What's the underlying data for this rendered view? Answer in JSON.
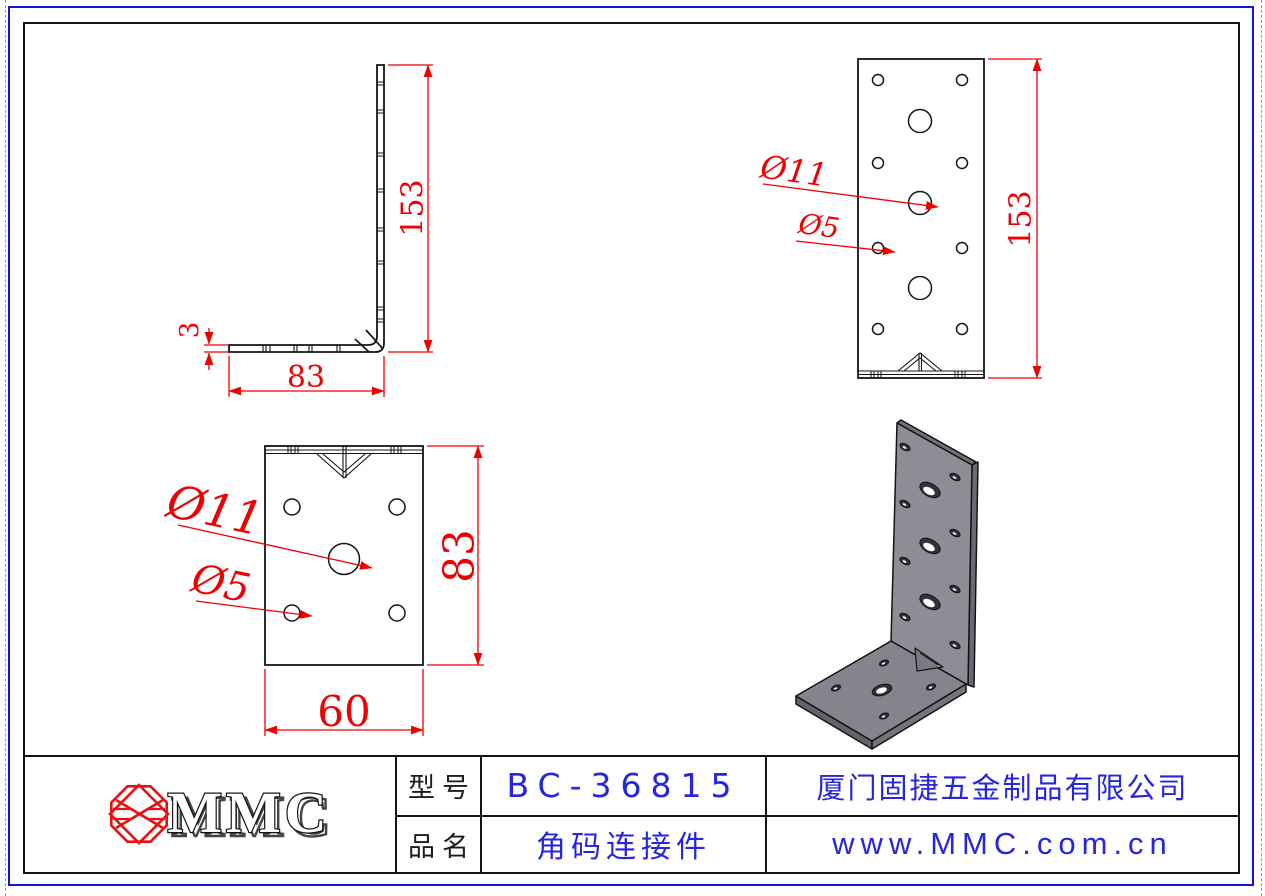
{
  "sheet": {
    "colors": {
      "dimension_red": "#ee0000",
      "cad_blue_text": "#2626de",
      "border_blue": "#1313dd",
      "line_black": "#141414",
      "metal_gray": "#8b8b93",
      "metal_edge_gray": "#6a6a74",
      "metal_base_gray": "#84848c"
    },
    "views": {
      "side": {
        "height": "153",
        "width": "83",
        "thickness": "3"
      },
      "front": {
        "height": "153",
        "big_hole": "Ø11",
        "small_hole": "Ø5"
      },
      "top": {
        "height": "83",
        "width": "60",
        "big_hole": "Ø11",
        "small_hole": "Ø5"
      }
    },
    "title_block": {
      "logo_text": "MMC",
      "model_label": "型号",
      "model_value": "BC-36815",
      "name_label": "品名",
      "name_value": "角码连接件",
      "company": "厦门固捷五金制品有限公司",
      "website": "www.MMC.com.cn"
    }
  }
}
